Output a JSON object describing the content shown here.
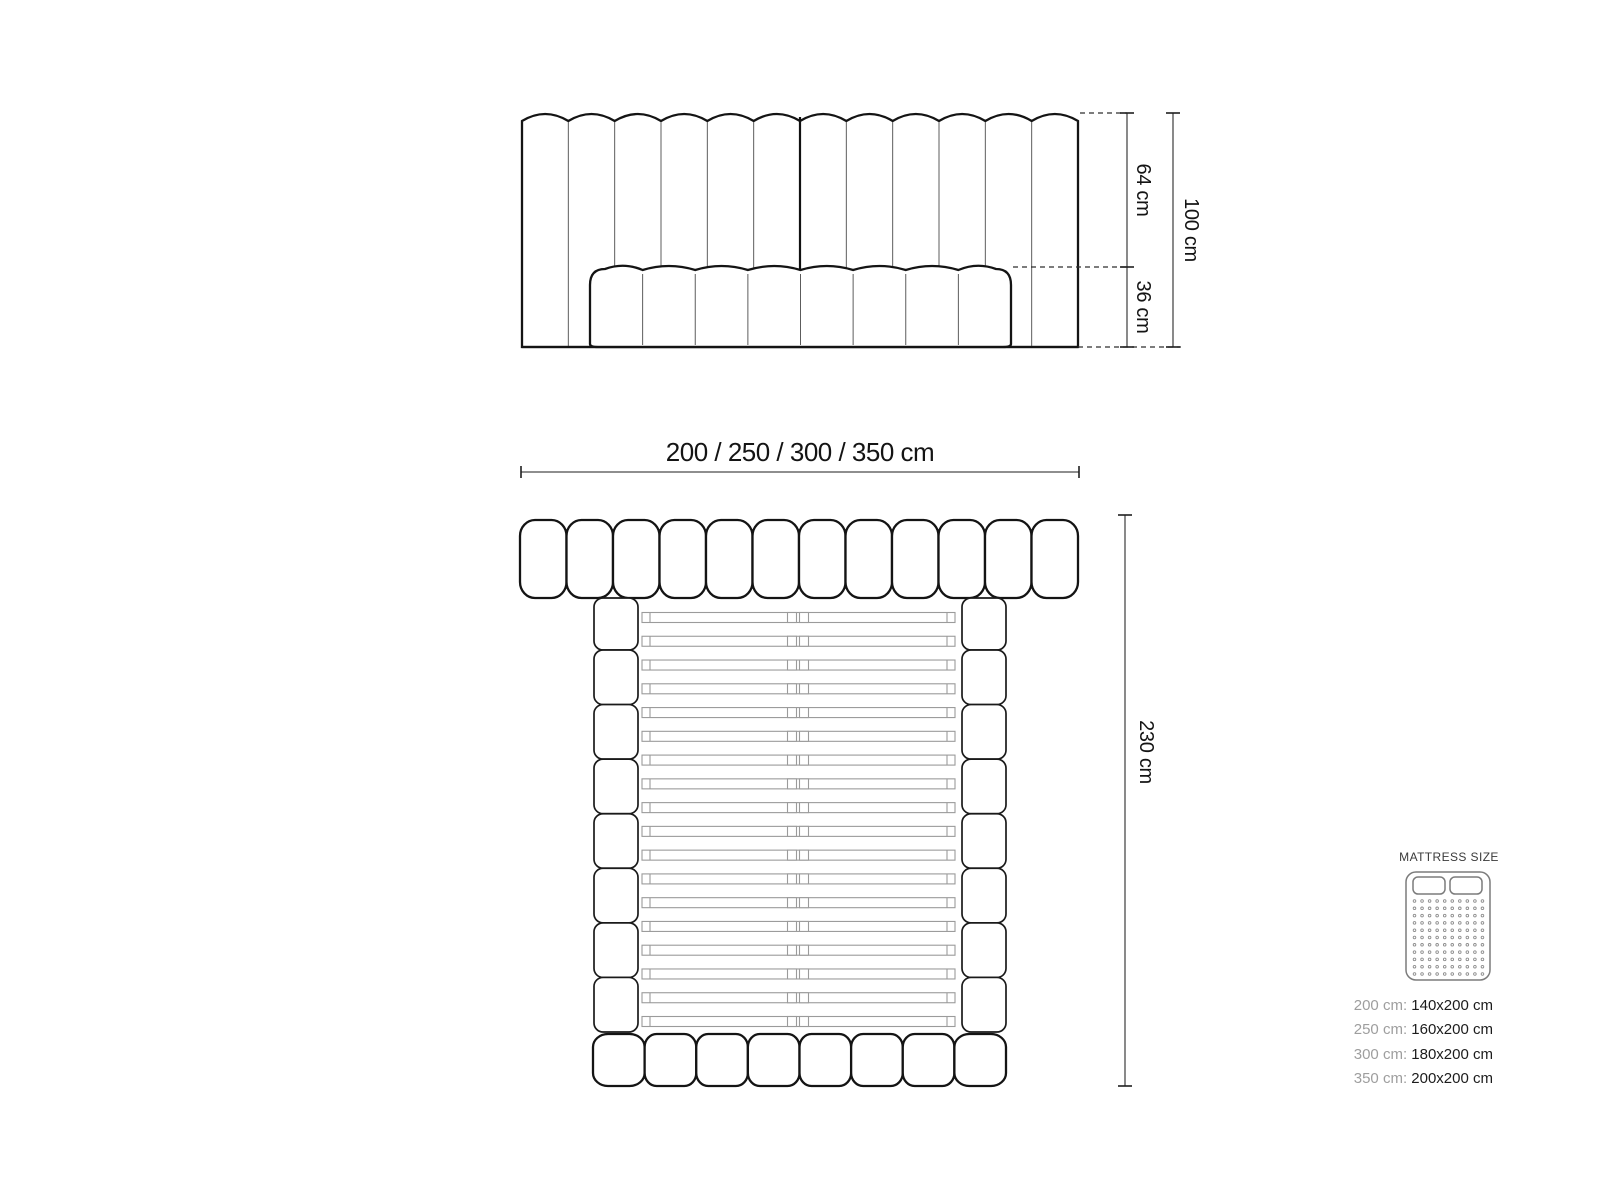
{
  "front_view": {
    "channels": 12,
    "inner_cushions": 8,
    "dim_upper": "64 cm",
    "dim_lower": "36 cm",
    "dim_total": "100 cm"
  },
  "width_dim_label": "200 / 250 / 300 / 350 cm",
  "plan_view": {
    "headboard_pills": 12,
    "rail_segments": 8,
    "slats": 18,
    "footboard_cushions": 8,
    "dim_height": "230 cm"
  },
  "legend": {
    "title": "MATTRESS SIZE",
    "icon": "double-mattress-top-icon",
    "rows": [
      {
        "prefix": "200 cm:",
        "value": "140x200 cm"
      },
      {
        "prefix": "250 cm:",
        "value": "160x200 cm"
      },
      {
        "prefix": "300 cm:",
        "value": "180x200 cm"
      },
      {
        "prefix": "350 cm:",
        "value": "200x200 cm"
      }
    ]
  },
  "colors": {
    "line": "#141414",
    "separator": "#5c5c5c",
    "slat": "#9b9b9b",
    "legend_gray": "#9e9e9e",
    "legend_dark": "#1c1c1c",
    "icon_gray": "#7c7c7c"
  }
}
